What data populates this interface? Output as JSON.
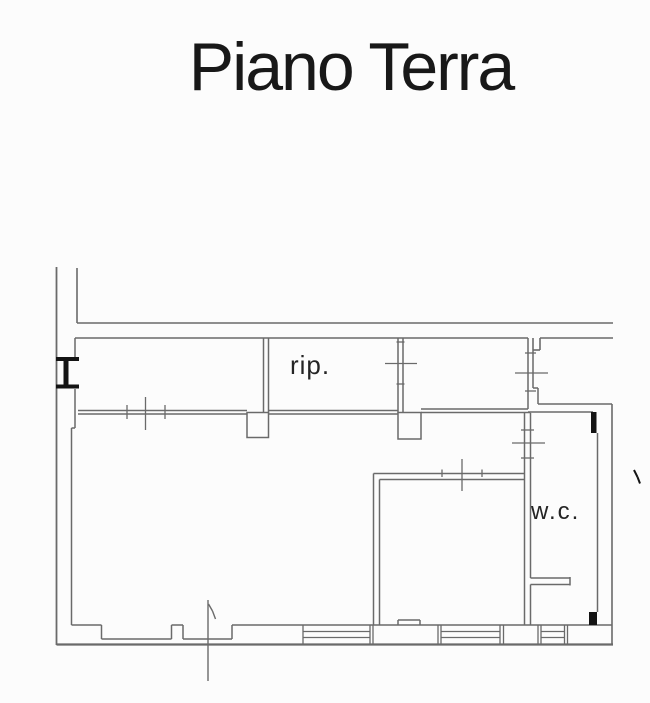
{
  "page": {
    "background": "#fcfcfc"
  },
  "title": {
    "text": "Piano Terra"
  },
  "floorplan": {
    "colors": {
      "line": "#6a6a6a",
      "dark": "#141414",
      "label": "#242424",
      "title": "#181818"
    },
    "groups": [
      {
        "name": "left-outer-wall",
        "w": 1.8,
        "lines": [
          [
            56.5,
            267,
            56.5,
            645
          ]
        ]
      },
      {
        "name": "upper-left-wall-stub",
        "w": 1.6,
        "lines": [
          [
            77,
            268,
            77,
            323
          ]
        ]
      },
      {
        "name": "top-wall",
        "w": 1.6,
        "lines": [
          [
            77,
            323,
            613,
            323
          ],
          [
            75,
            338,
            528,
            338
          ],
          [
            540,
            338,
            613,
            338
          ],
          [
            533,
            338,
            533,
            350
          ],
          [
            533,
            350,
            540,
            350
          ],
          [
            540,
            338,
            540,
            350
          ]
        ]
      },
      {
        "name": "right-outer-wall",
        "w": 1.6,
        "lines": [
          [
            538,
            404,
            612,
            404
          ],
          [
            612,
            404,
            612,
            644
          ]
        ]
      },
      {
        "name": "bottom-outer-wall",
        "w": 2.2,
        "lines": [
          [
            56.5,
            644.5,
            613,
            644.5
          ]
        ]
      },
      {
        "name": "left-inner-wall",
        "w": 1.5,
        "lines": [
          [
            75,
            338,
            75,
            357
          ],
          [
            75,
            389,
            75,
            428
          ],
          [
            71.5,
            428,
            75,
            428
          ],
          [
            71.5,
            428,
            71.5,
            625
          ]
        ]
      },
      {
        "name": "main-interior-wall",
        "w": 1.5,
        "lines": [
          [
            78,
            410.5,
            247,
            410.5
          ],
          [
            78,
            414,
            247,
            414
          ],
          [
            268.5,
            410.5,
            398,
            410.5
          ],
          [
            268.5,
            414,
            398,
            414
          ],
          [
            421,
            409,
            528,
            409
          ],
          [
            421,
            412.5,
            530.5,
            412.5
          ]
        ]
      },
      {
        "name": "main-wall-door-ticks",
        "w": 1.3,
        "lines": [
          [
            127,
            405,
            127,
            419
          ],
          [
            145.5,
            397,
            145.5,
            430
          ],
          [
            165,
            405,
            165,
            419
          ]
        ]
      },
      {
        "name": "rip-left-wall",
        "w": 1.5,
        "lines": [
          [
            263.5,
            338,
            263.5,
            412.5
          ],
          [
            268.5,
            338,
            268.5,
            412.5
          ]
        ]
      },
      {
        "name": "rip-right-wall",
        "w": 1.5,
        "lines": [
          [
            398,
            338,
            398,
            412.5
          ],
          [
            403,
            338,
            403,
            412.5
          ]
        ]
      },
      {
        "name": "rip-door-tick",
        "w": 1.3,
        "lines": [
          [
            385,
            363.5,
            417,
            363.5
          ],
          [
            396.5,
            342,
            404.5,
            342
          ],
          [
            396.5,
            384,
            404.5,
            384
          ]
        ]
      },
      {
        "name": "wc-upper-wall",
        "w": 1.5,
        "lines": [
          [
            528,
            338,
            528,
            409
          ],
          [
            533,
            350,
            533,
            388
          ],
          [
            533,
            388,
            538,
            388
          ],
          [
            538,
            388,
            538,
            404
          ]
        ]
      },
      {
        "name": "wc-upper-door-tick",
        "w": 1.3,
        "lines": [
          [
            515,
            373,
            548,
            373
          ],
          [
            525,
            353,
            536,
            353
          ],
          [
            525,
            391,
            536,
            391
          ]
        ]
      },
      {
        "name": "wc-top-edge",
        "w": 1.5,
        "lines": [
          [
            528,
            412,
            593,
            412
          ]
        ]
      },
      {
        "name": "wc-right-wall",
        "w": 1.5,
        "lines": [
          [
            597.5,
            433,
            597.5,
            612
          ]
        ]
      },
      {
        "name": "wc-left-wall",
        "w": 1.5,
        "lines": [
          [
            524.5,
            412.5,
            524.5,
            625
          ],
          [
            530.5,
            413,
            530.5,
            578
          ],
          [
            530.5,
            584.5,
            530.5,
            625
          ]
        ]
      },
      {
        "name": "wc-door-tick",
        "w": 1.3,
        "lines": [
          [
            512,
            443,
            545,
            443
          ],
          [
            521,
            430,
            534,
            430
          ],
          [
            521,
            458,
            534,
            458
          ]
        ]
      },
      {
        "name": "wc-stub-wall",
        "w": 1.5,
        "lines": [
          [
            530.5,
            578,
            570,
            578
          ],
          [
            530.5,
            584.5,
            570,
            584.5
          ],
          [
            570,
            577,
            570,
            585.5
          ]
        ]
      },
      {
        "name": "bottom-room-walls",
        "w": 1.5,
        "lines": [
          [
            373.5,
            473.5,
            373.5,
            625
          ],
          [
            379.5,
            479.5,
            379.5,
            625
          ],
          [
            373.5,
            473.5,
            524.5,
            473.5
          ],
          [
            379.5,
            479.5,
            524.5,
            479.5
          ]
        ]
      },
      {
        "name": "bottom-room-door-tick",
        "w": 1.3,
        "lines": [
          [
            462,
            459,
            462,
            491
          ],
          [
            442,
            469.5,
            442,
            477
          ],
          [
            482,
            469.5,
            482,
            477
          ]
        ]
      },
      {
        "name": "bottom-wall-inner",
        "w": 1.5,
        "lines": [
          [
            71.5,
            625,
            101.5,
            625
          ],
          [
            101.5,
            625,
            101.5,
            639
          ],
          [
            101.5,
            639,
            171.5,
            639
          ],
          [
            171.5,
            625,
            171.5,
            639
          ],
          [
            171.5,
            625,
            183,
            625
          ],
          [
            183,
            625,
            183,
            639
          ],
          [
            183,
            639,
            232,
            639
          ],
          [
            232,
            625,
            232,
            639
          ],
          [
            232,
            625,
            612,
            625
          ],
          [
            398,
            620,
            420,
            620
          ],
          [
            398,
            620,
            398,
            625
          ],
          [
            420,
            620,
            420,
            625
          ]
        ]
      },
      {
        "name": "bottom-window-symbol-1",
        "w": 1.3,
        "lines": [
          [
            303,
            625,
            303,
            644
          ],
          [
            370,
            625,
            370,
            644
          ],
          [
            373,
            625,
            373,
            644
          ],
          [
            303,
            631.5,
            370,
            631.5
          ],
          [
            303,
            637.5,
            370,
            637.5
          ]
        ]
      },
      {
        "name": "bottom-window-symbol-2",
        "w": 1.3,
        "lines": [
          [
            438,
            625,
            438,
            644
          ],
          [
            441,
            625,
            441,
            644
          ],
          [
            500,
            625,
            500,
            644
          ],
          [
            503.5,
            625,
            503.5,
            644
          ],
          [
            441,
            631.5,
            500,
            631.5
          ],
          [
            441,
            637.5,
            500,
            637.5
          ]
        ]
      },
      {
        "name": "bottom-window-symbol-3",
        "w": 1.3,
        "lines": [
          [
            538,
            625,
            538,
            644
          ],
          [
            541,
            625,
            541,
            644
          ],
          [
            564.5,
            625,
            564.5,
            644
          ],
          [
            567.5,
            625,
            567.5,
            644
          ],
          [
            541,
            631.5,
            564.5,
            631.5
          ],
          [
            541,
            637.5,
            564.5,
            637.5
          ]
        ]
      },
      {
        "name": "entrance-door-swing",
        "w": 1.4,
        "lines": [
          [
            208,
            600,
            208,
            681
          ],
          [
            208.5,
            604,
            212.5,
            611
          ],
          [
            212.5,
            611,
            215.5,
            619
          ]
        ]
      },
      {
        "name": "pillar-left",
        "w": 1.5,
        "rects": [
          [
            247,
            412.5,
            21.5,
            25
          ]
        ]
      },
      {
        "name": "pillar-right",
        "w": 1.5,
        "rects": [
          [
            398,
            412.5,
            23,
            26.5
          ]
        ]
      },
      {
        "name": "left-window-symbol",
        "fill": true,
        "rects": [
          [
            56,
            357,
            23,
            4
          ],
          [
            56,
            384.5,
            23,
            4
          ],
          [
            63.5,
            360,
            5,
            25
          ]
        ]
      },
      {
        "name": "wc-dark-corner-top",
        "fill": true,
        "rects": [
          [
            591,
            412,
            5.5,
            21
          ]
        ]
      },
      {
        "name": "wc-dark-corner-bottom",
        "fill": true,
        "rects": [
          [
            589,
            612,
            8,
            13
          ]
        ]
      },
      {
        "name": "right-edge-mark",
        "w": 2,
        "dark": true,
        "lines": [
          [
            634,
            470,
            637.5,
            477
          ],
          [
            637.5,
            477,
            640,
            483.5
          ]
        ]
      }
    ],
    "labels": [
      {
        "name": "room-label-rip",
        "text": "rip.",
        "x": 290,
        "y": 374,
        "size": 26,
        "ls": 1
      },
      {
        "name": "room-label-wc",
        "text": "w.c.",
        "x": 531,
        "y": 519,
        "size": 24,
        "ls": 2
      }
    ]
  }
}
